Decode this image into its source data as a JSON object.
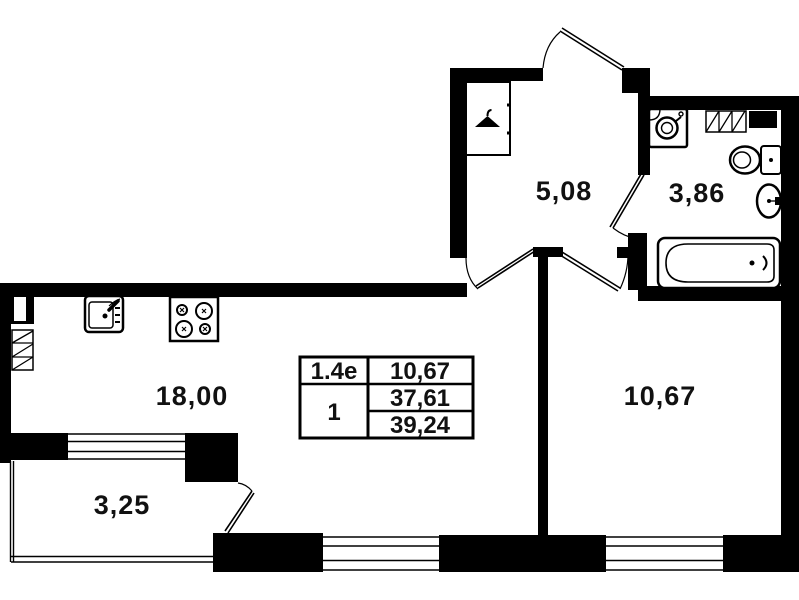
{
  "title": "apartment-floor-plan",
  "colors": {
    "wall": "#000000",
    "background": "#ffffff",
    "text": "#111111"
  },
  "rooms": {
    "hall": {
      "area": "5,08"
    },
    "bathroom": {
      "area": "3,86"
    },
    "living_kitchen": {
      "area": "18,00"
    },
    "bedroom": {
      "area": "10,67"
    },
    "balcony": {
      "area": "3,25"
    }
  },
  "info_table": {
    "col1": [
      "1.4е",
      "1"
    ],
    "col2": [
      "10,67",
      "37,61",
      "39,24"
    ]
  },
  "icons": {
    "wardrobe": "hanger-icon",
    "kitchen": [
      "kitchen-sink-icon",
      "stove-icon",
      "vent-shaft-icon"
    ],
    "bathroom": [
      "washing-machine-icon",
      "shelf-icon",
      "vent-icon",
      "toilet-icon",
      "washbasin-icon",
      "bathtub-icon"
    ]
  }
}
